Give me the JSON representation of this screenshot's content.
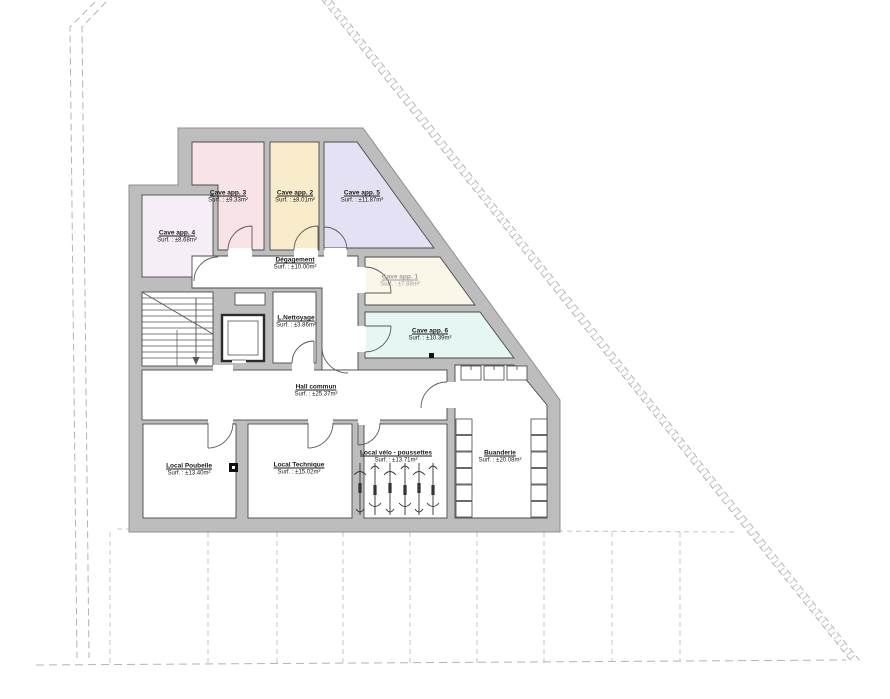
{
  "drawing": {
    "type_label": "floor-plan",
    "colors": {
      "wall_fill": "#bdbdbd",
      "wall_edge": "#8f8f8f",
      "interior_line": "#4a4a4a",
      "fixture_line": "#444444",
      "boundary_dash": "#b3b3b3",
      "background": "#ffffff"
    }
  },
  "rooms": {
    "cave3": {
      "name": "Cave app. 3",
      "area": "Surf. : ±9.33m²",
      "color": "#f8e3e6"
    },
    "cave2": {
      "name": "Cave app. 2",
      "area": "Surf. : ±8.01m²",
      "color": "#f8ecca"
    },
    "cave5": {
      "name": "Cave app. 5",
      "area": "Surf. : ±11.87m²",
      "color": "#e3e1f3"
    },
    "cave4": {
      "name": "Cave app. 4",
      "area": "Surf. : ±8.68m²",
      "color": "#f5eef7"
    },
    "cave1": {
      "name": "Cave app. 1",
      "area": "Surf. : ±7.88m²",
      "color": "#faf7e8"
    },
    "cave6": {
      "name": "Cave app. 6",
      "area": "Surf. : ±10.39m²",
      "color": "#e6f6f3"
    },
    "degagement": {
      "name": "Dégagement",
      "area": "Surf. : ±10.00m²",
      "color": "#ffffff"
    },
    "nettoyage": {
      "name": "L.Nettoyage",
      "area": "Surf. : ±3.86m²",
      "color": "#ffffff"
    },
    "hall": {
      "name": "Hall commun",
      "area": "Surf. : ±25.37m²",
      "color": "#ffffff"
    },
    "poubelle": {
      "name": "Local Poubelle",
      "area": "Surf. : ±13.40m²",
      "color": "#ffffff"
    },
    "technique": {
      "name": "Local Technique",
      "area": "Surf. : ±15.02m²",
      "color": "#ffffff"
    },
    "velo": {
      "name": "Local vélo - poussettes",
      "area": "Surf. : ±13.71m²",
      "color": "#ffffff"
    },
    "buanderie": {
      "name": "Buanderie",
      "area": "Surf. : ±20.08m²",
      "color": "#ffffff"
    }
  }
}
